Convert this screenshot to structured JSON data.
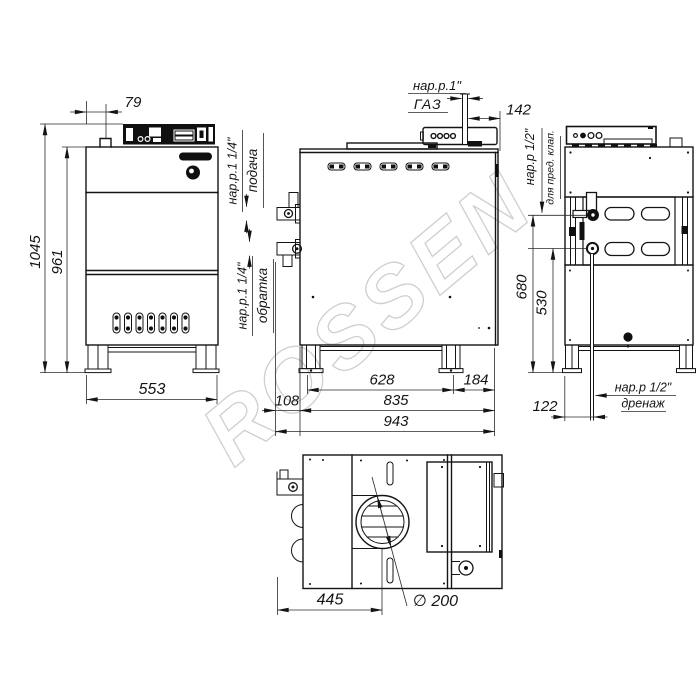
{
  "watermark": "ROSSEN",
  "front_view": {
    "dim_panel_offset": "79",
    "dim_height_overall": "1045",
    "dim_height_body": "961",
    "dim_width": "553"
  },
  "side_view": {
    "gas_thread": "нар.р.1\"",
    "gas_label": "ГАЗ",
    "dim_gas_to_back": "142",
    "supply_thread": "нар.р.1 1/4\"",
    "supply_label": "подача",
    "return_thread": "нар.р.1 1/4\"",
    "return_label": "обратка",
    "dim_legs_span": "628",
    "dim_leg_to_back": "184",
    "dim_pipe_overhang": "108",
    "dim_body_depth": "835",
    "dim_overall_depth": "943"
  },
  "back_view": {
    "safety_thread": "нар.р 1/2\"",
    "safety_label": "для пред. клап.",
    "dim_safety_height": "680",
    "dim_drain_height": "530",
    "dim_drain_offset": "122",
    "drain_thread": "нар.р 1/2\"",
    "drain_label": "дренаж"
  },
  "top_view": {
    "dim_flue_center": "445",
    "dim_flue_diameter": "∅ 200"
  }
}
